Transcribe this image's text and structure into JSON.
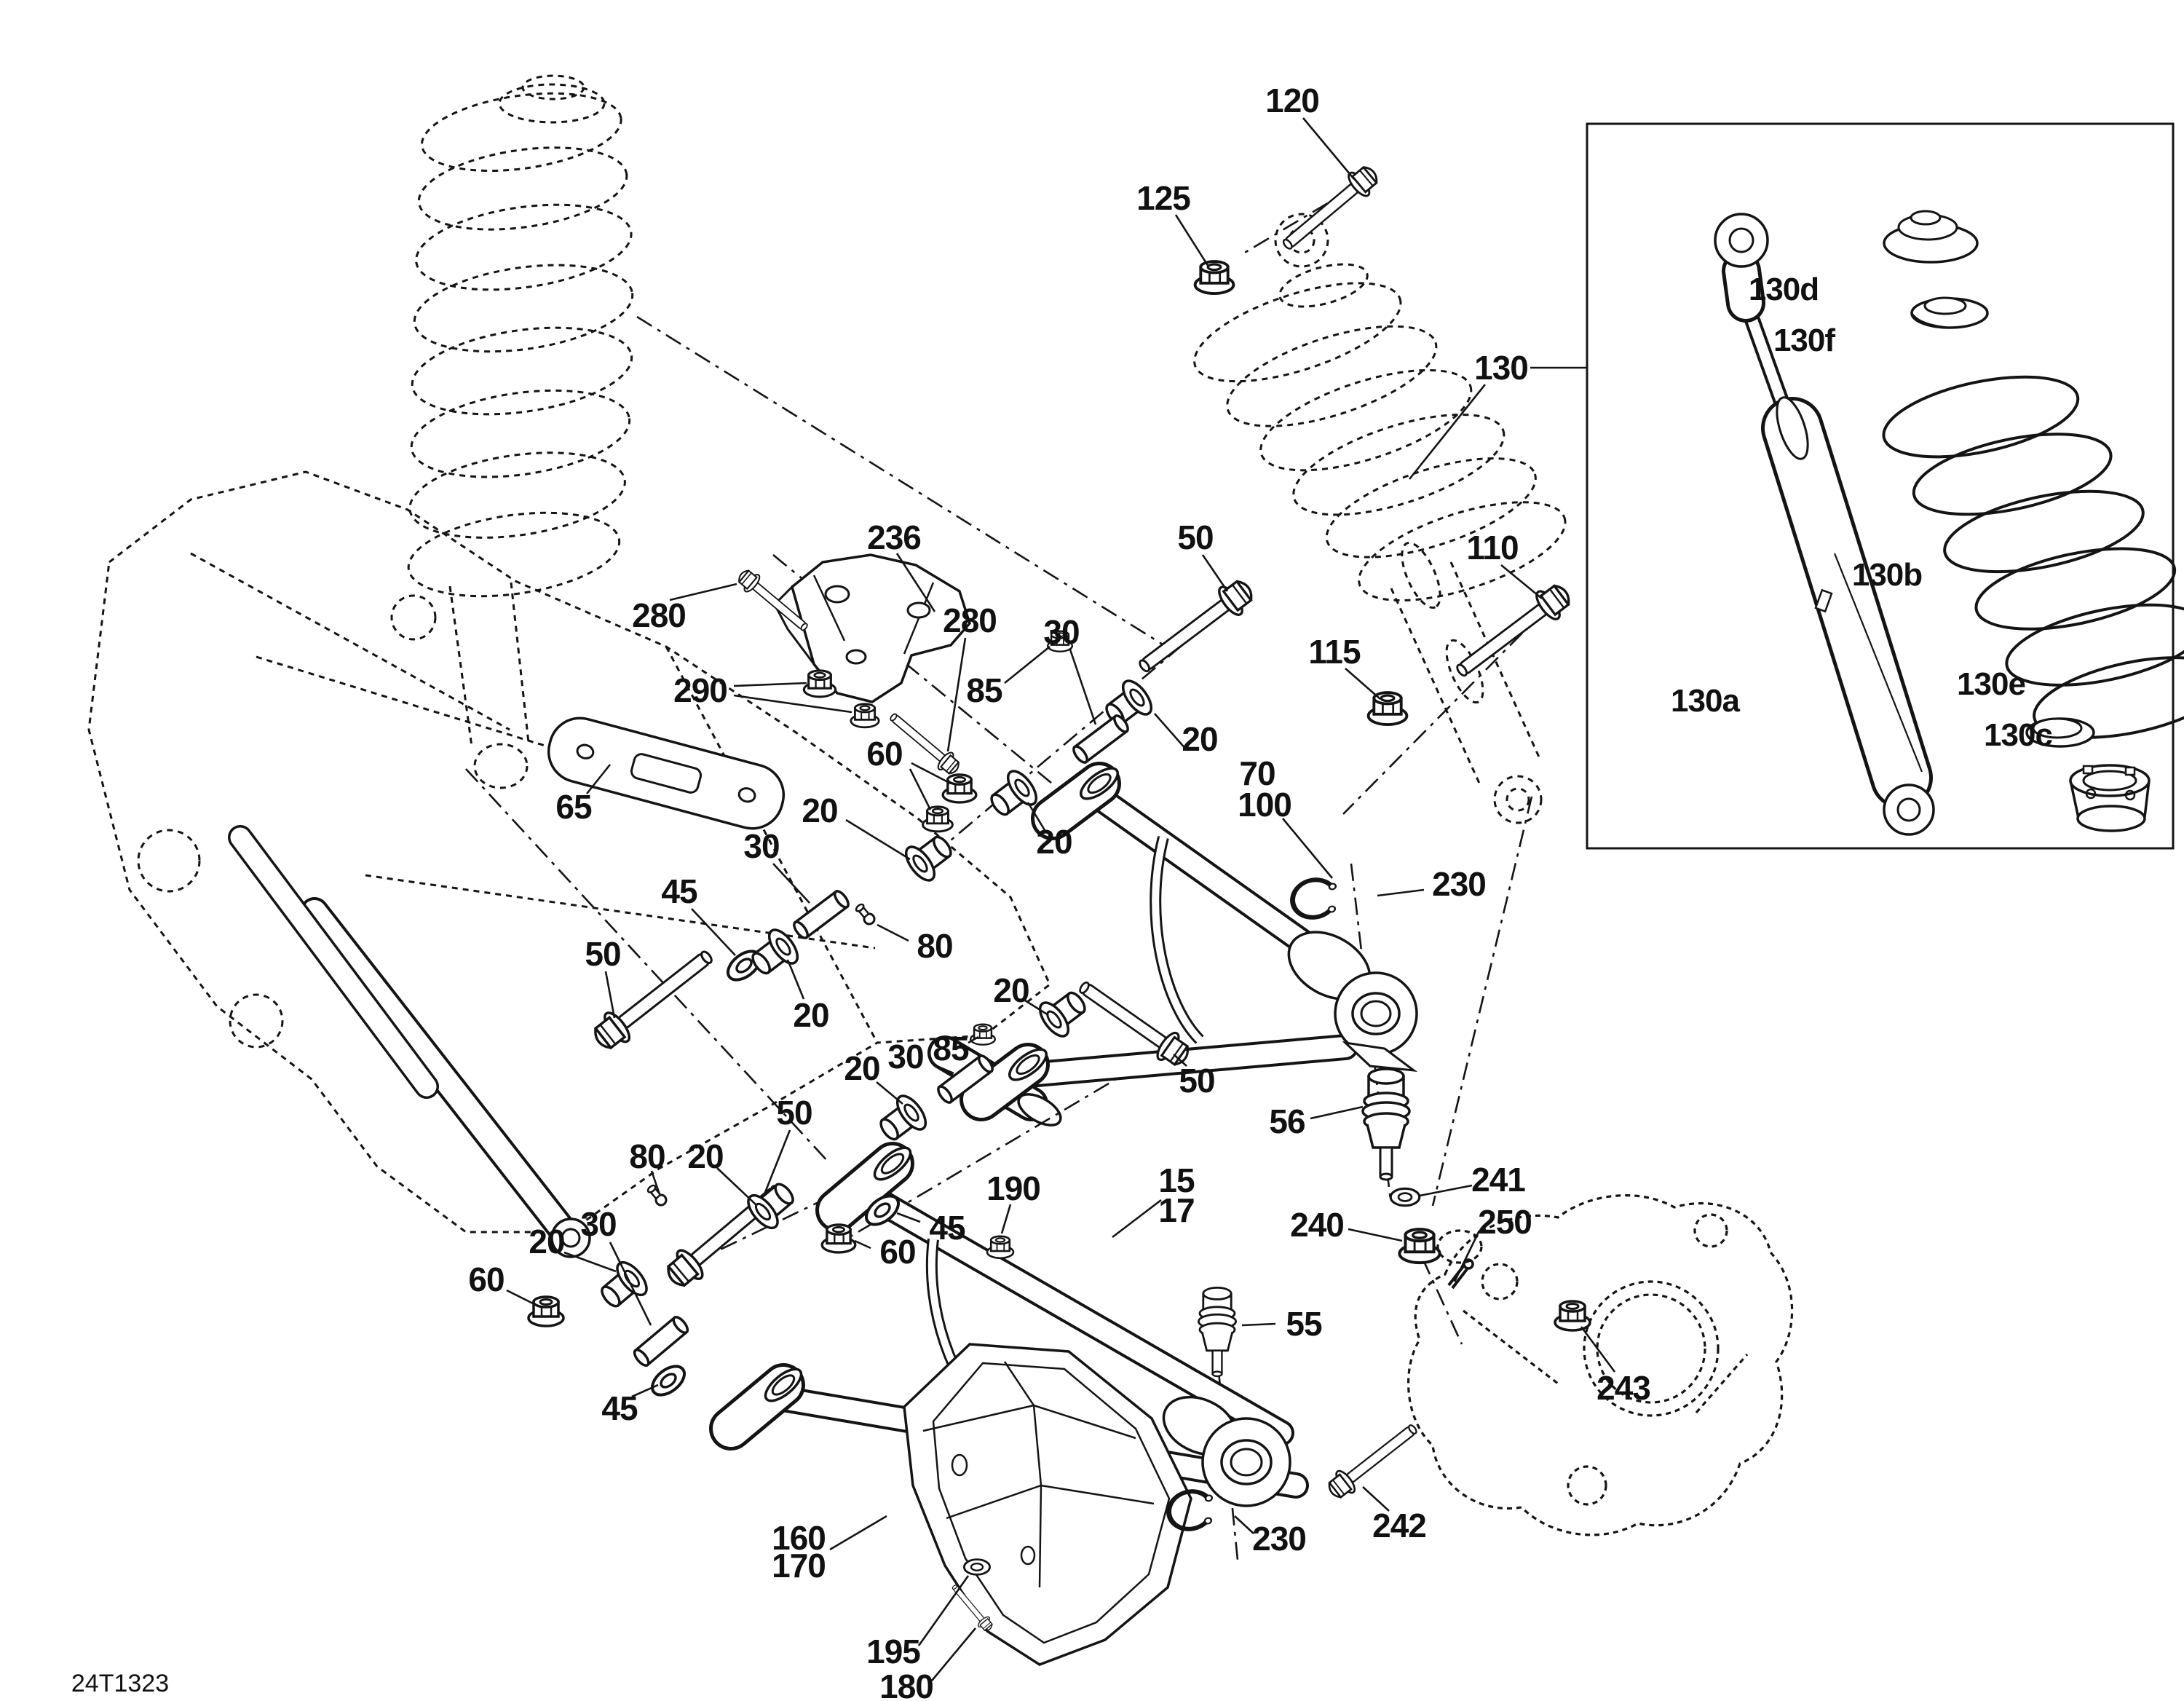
{
  "page": {
    "background": "#ffffff",
    "ink": "#141414",
    "drawing_code": "24T1323",
    "type": "exploded-parts-diagram",
    "subject": "front suspension arms and shock"
  },
  "callouts": [
    {
      "text": "120"
    },
    {
      "text": "125"
    },
    {
      "text": "130"
    },
    {
      "text": "236"
    },
    {
      "text": "280"
    },
    {
      "text": "290"
    },
    {
      "text": "280"
    },
    {
      "text": "50"
    },
    {
      "text": "30"
    },
    {
      "text": "85"
    },
    {
      "text": "20"
    },
    {
      "text": "110"
    },
    {
      "text": "115"
    },
    {
      "text": "60"
    },
    {
      "text": "20"
    },
    {
      "text": "20"
    },
    {
      "text": "70"
    },
    {
      "text": "100"
    },
    {
      "text": "230"
    },
    {
      "text": "30"
    },
    {
      "text": "45"
    },
    {
      "text": "50"
    },
    {
      "text": "20"
    },
    {
      "text": "80"
    },
    {
      "text": "20"
    },
    {
      "text": "85"
    },
    {
      "text": "30"
    },
    {
      "text": "20"
    },
    {
      "text": "50"
    },
    {
      "text": "50"
    },
    {
      "text": "80"
    },
    {
      "text": "20"
    },
    {
      "text": "30"
    },
    {
      "text": "20"
    },
    {
      "text": "60"
    },
    {
      "text": "45"
    },
    {
      "text": "60"
    },
    {
      "text": "45"
    },
    {
      "text": "190"
    },
    {
      "text": "15"
    },
    {
      "text": "17"
    },
    {
      "text": "56"
    },
    {
      "text": "55"
    },
    {
      "text": "241"
    },
    {
      "text": "240"
    },
    {
      "text": "250"
    },
    {
      "text": "243"
    },
    {
      "text": "242"
    },
    {
      "text": "230"
    },
    {
      "text": "160"
    },
    {
      "text": "170"
    },
    {
      "text": "195"
    },
    {
      "text": "180"
    },
    {
      "text": "65"
    },
    {
      "text": "130d"
    },
    {
      "text": "130f"
    },
    {
      "text": "130b"
    },
    {
      "text": "130a"
    },
    {
      "text": "130e"
    },
    {
      "text": "130c"
    },
    {
      "text": "24T1323"
    }
  ]
}
